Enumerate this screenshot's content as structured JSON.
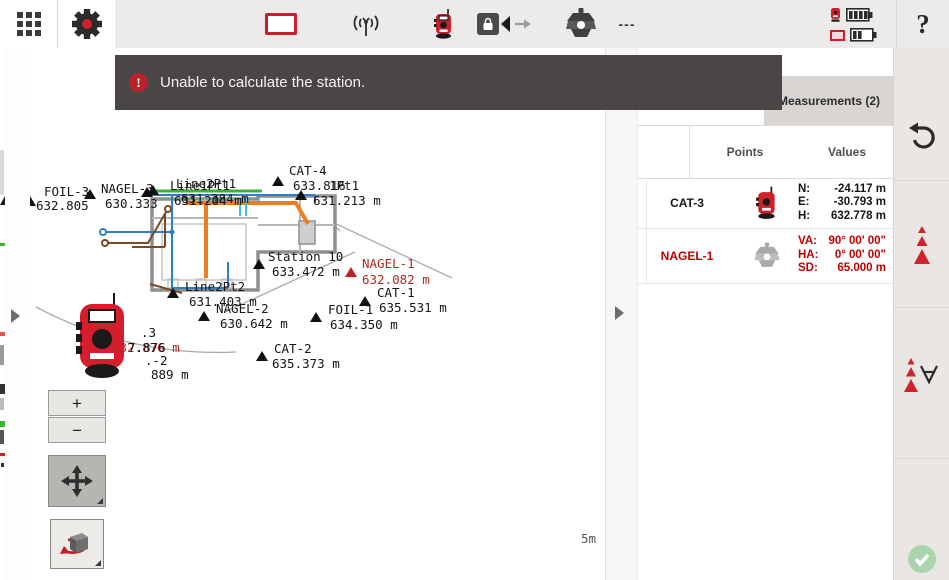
{
  "toolbar": {
    "dashes": "---",
    "help_label": "?"
  },
  "banner": {
    "text": "Unable to calculate the station."
  },
  "panel": {
    "tab_label": "Measurements (2)",
    "columns": {
      "points": "Points",
      "values": "Values"
    },
    "rows": [
      {
        "name": "CAT-3",
        "icon": "total-station-icon",
        "values": [
          {
            "k": "N:",
            "v": "-24.117 m"
          },
          {
            "k": "E:",
            "v": "-30.793 m"
          },
          {
            "k": "H:",
            "v": "632.778 m"
          }
        ]
      },
      {
        "name": "NAGEL-1",
        "icon": "prism-icon",
        "values": [
          {
            "k": "VA:",
            "v": "90° 00' 00\""
          },
          {
            "k": "HA:",
            "v": "0° 00' 00\""
          },
          {
            "k": "SD:",
            "v": "65.000 m"
          }
        ]
      }
    ]
  },
  "map": {
    "zoom_in": "+",
    "zoom_out": "−",
    "scale_label": "5m",
    "points": [
      {
        "name": "FOIL-3",
        "value": "632.805",
        "tri": [
          30,
          206
        ],
        "np": [
          44,
          196
        ],
        "vp": [
          36,
          210
        ]
      },
      {
        "name": "NAGEL-3",
        "value": "630.333",
        "tri": [
          90,
          199
        ],
        "np": [
          101,
          193
        ],
        "vp": [
          105,
          208
        ]
      },
      {
        "name": "Line1Pt1",
        "value": "631.204 m",
        "tri": [
          147,
          197
        ],
        "np": [
          170,
          190
        ],
        "vp": [
          174,
          205
        ]
      },
      {
        "name": "Line2Pt1",
        "value": "631.384 m",
        "tri": [
          153,
          195
        ],
        "np": [
          176,
          188
        ],
        "vp": [
          181,
          203
        ]
      },
      {
        "name": "CAT-4",
        "value": "633.816",
        "tri": [
          278,
          186
        ],
        "np": [
          289,
          175
        ],
        "vp": [
          293,
          190
        ]
      },
      {
        "name": "1Pt1",
        "np": [
          329,
          190
        ]
      },
      {
        "value": "631.213 m",
        "tri": [
          301,
          200
        ],
        "vp": [
          313,
          205
        ]
      },
      {
        "name": "Station 10",
        "value": "633.472  m",
        "tri": [
          259,
          269
        ],
        "np": [
          268,
          261
        ],
        "vp": [
          272,
          276
        ]
      },
      {
        "name": "NAGEL-1",
        "value": "632.082 m",
        "color": "#b22a27",
        "tri": [
          351,
          277
        ],
        "tri_color": "#c41e25",
        "np": [
          362,
          268
        ],
        "vp": [
          362,
          284
        ]
      },
      {
        "name": "CAT-1",
        "value": "635.531 m",
        "tri": [
          365,
          306
        ],
        "np": [
          377,
          297
        ],
        "vp": [
          379,
          312
        ]
      },
      {
        "name": "FOIL-1",
        "value": "634.350 m",
        "tri": [
          316,
          322
        ],
        "np": [
          328,
          314
        ],
        "vp": [
          330,
          329
        ]
      },
      {
        "name": "NAGEL-2",
        "value": "630.642 m",
        "tri": [
          204,
          321
        ],
        "np": [
          216,
          313
        ],
        "vp": [
          220,
          328
        ]
      },
      {
        "name": "Line2Pt2",
        "value": "631.403 m",
        "tri": [
          173,
          298
        ],
        "np": [
          185,
          291
        ],
        "vp": [
          189,
          306
        ]
      },
      {
        "name": "CAT-2",
        "value": "635.373 m",
        "tri": [
          262,
          361
        ],
        "np": [
          274,
          353
        ],
        "vp": [
          272,
          368
        ]
      },
      {
        "name": ".3",
        "np": [
          141,
          337
        ]
      },
      {
        "name": "632.876 m",
        "color": "#b22a27",
        "np": [
          112,
          352
        ]
      },
      {
        "name": "7.876",
        "np": [
          128,
          352
        ]
      },
      {
        "name": ".-2",
        "np": [
          145,
          365
        ]
      },
      {
        "name": "889 m",
        "np": [
          151,
          379
        ]
      }
    ]
  },
  "colors": {
    "accent_red": "#cf1f2b",
    "error_red": "#c00000",
    "banner_bg": "#4a4646"
  }
}
